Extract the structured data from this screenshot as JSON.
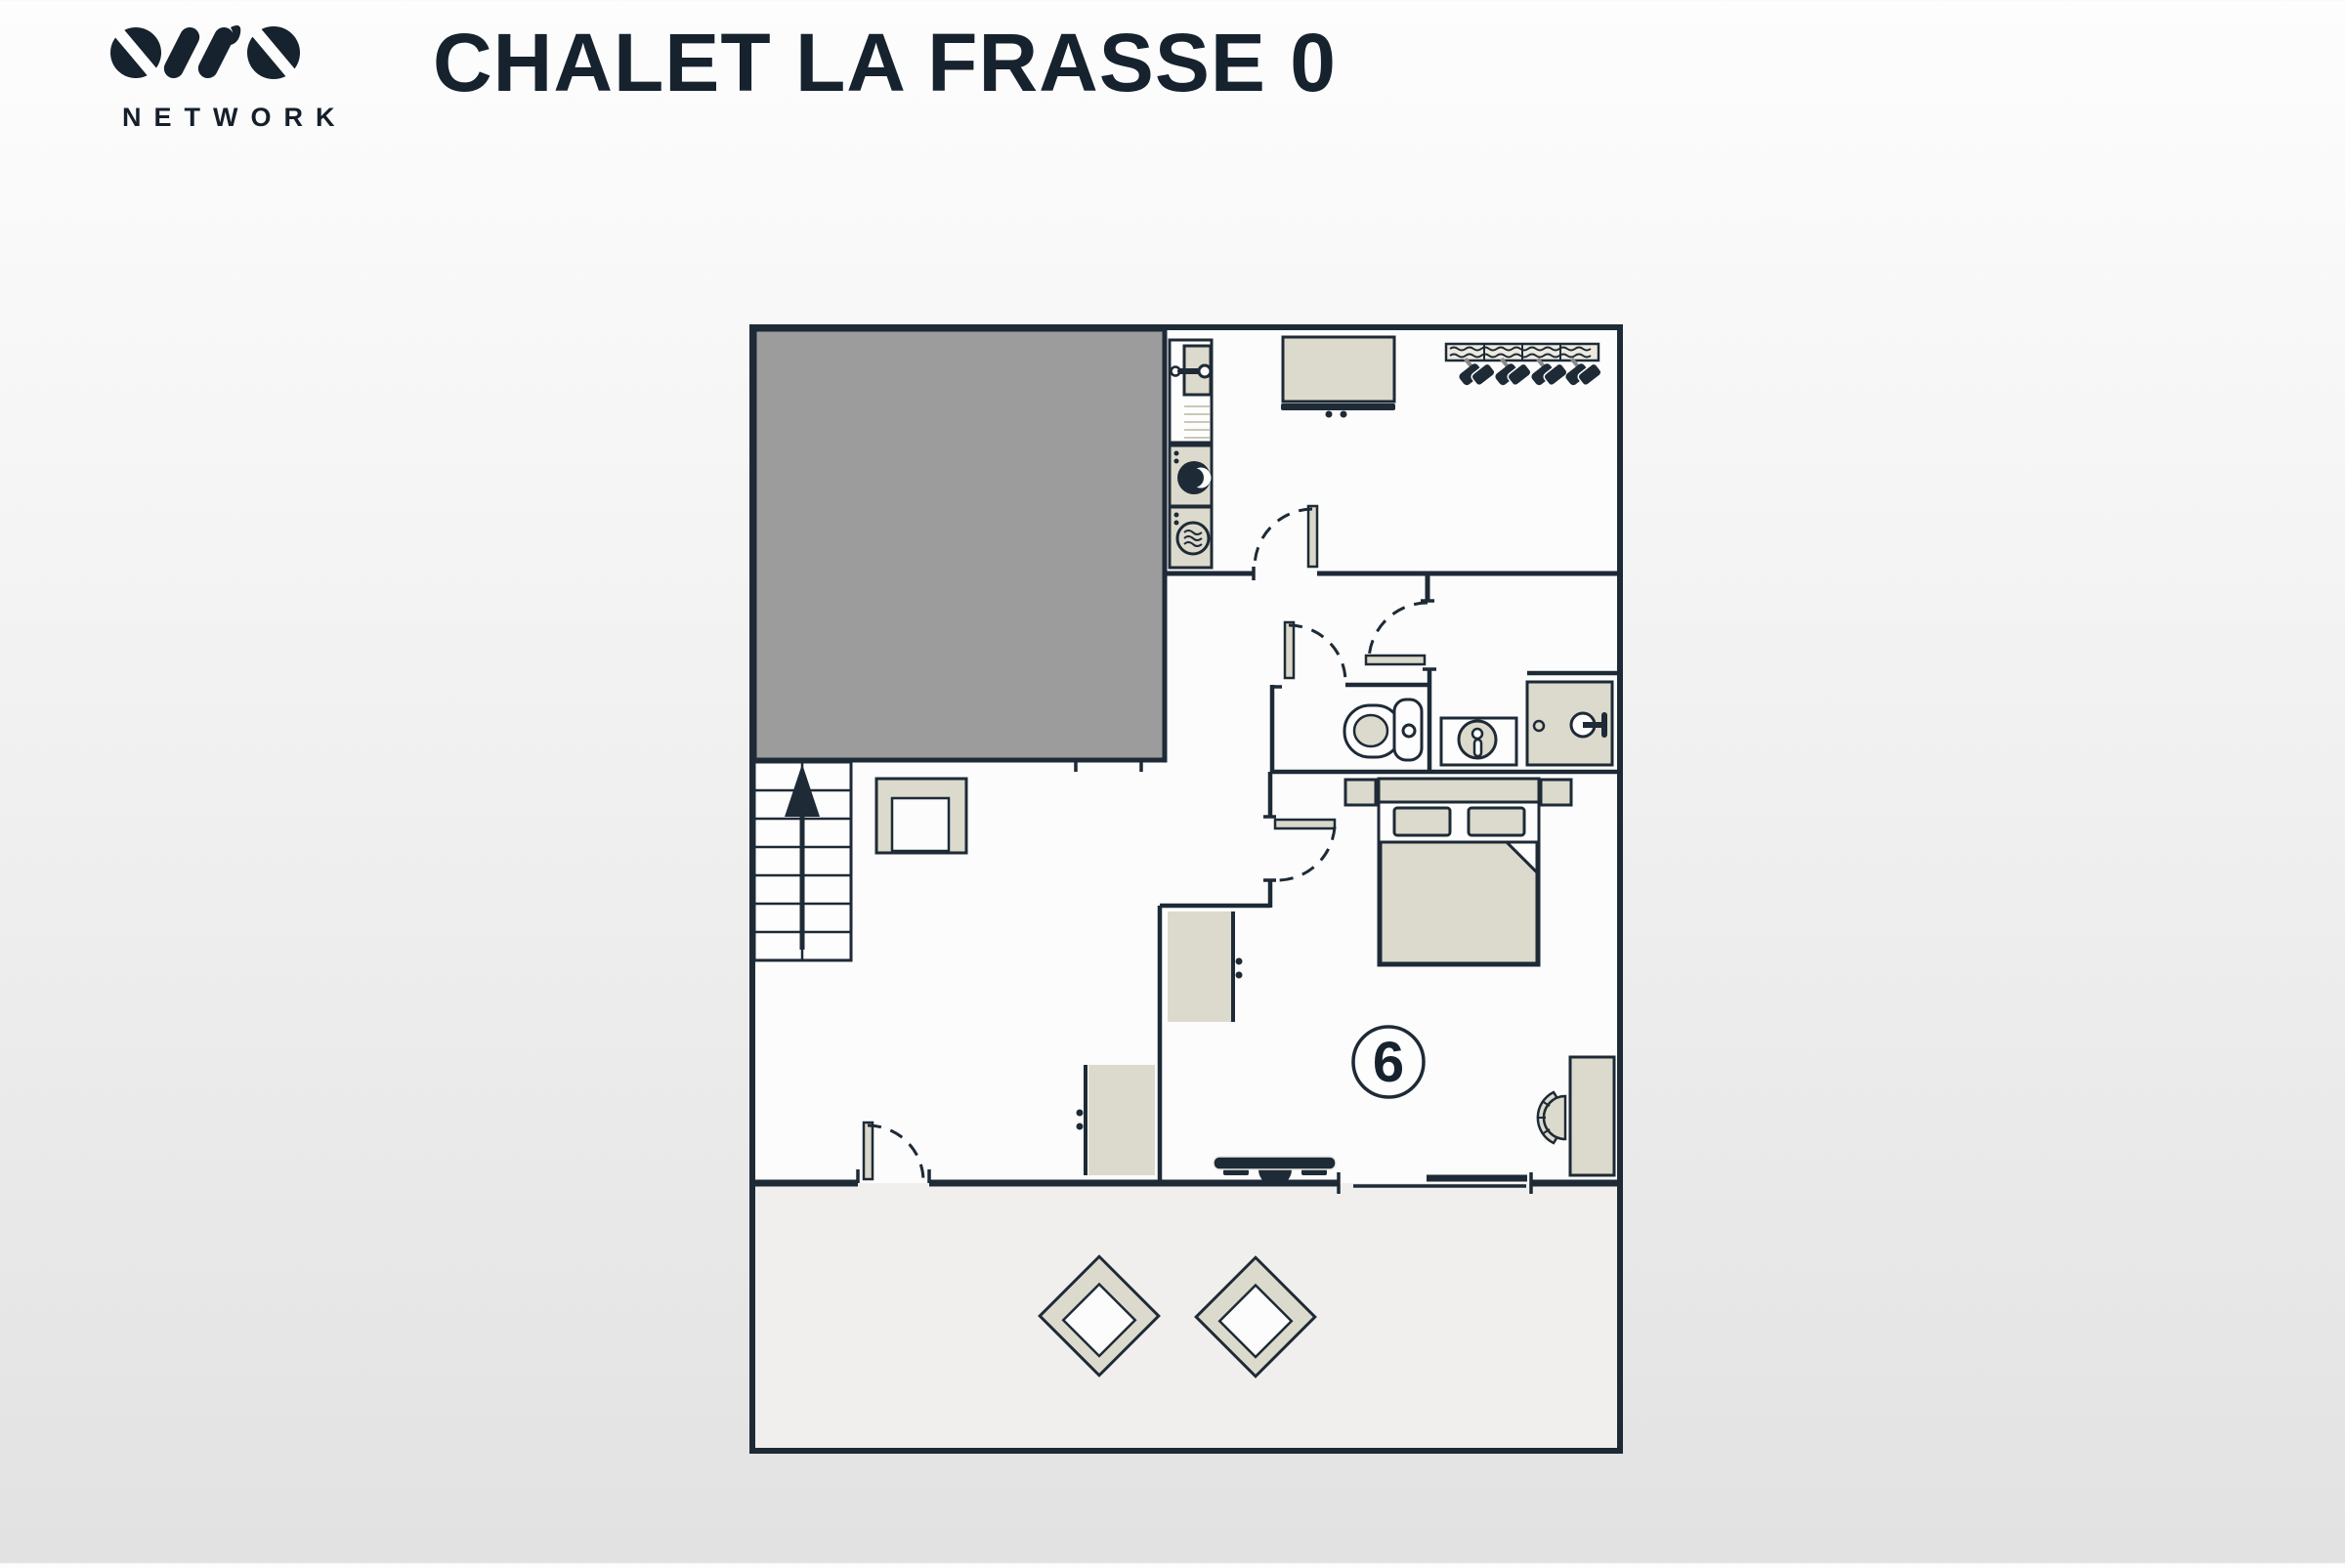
{
  "header": {
    "logo": {
      "icon": "ovo-logo-mark",
      "subtext": "NETWORK"
    },
    "title": "CHALET LA FRASSE 0"
  },
  "plan": {
    "bedroom_number": "6",
    "symbols": [
      "garage-void-area",
      "stairs-up-arrow",
      "sofa",
      "entrance-door",
      "kitchen-sink-unit",
      "washing-machine",
      "tumble-dryer",
      "sideboard",
      "boot-warmer-rack",
      "interior-door",
      "toilet",
      "washbasin",
      "shower-cubicle",
      "double-bed",
      "nightstand",
      "wardrobe",
      "tv",
      "desk",
      "desk-chair",
      "sliding-window",
      "terrace-armchair"
    ]
  },
  "colors": {
    "wall": "#1e2a36",
    "furniture_fill": "#dbdacc",
    "garage_fill": "#9c9c9c",
    "floor_fill": "#fcfcfc",
    "terrace_fill": "#f0efee",
    "title_color": "#16222d",
    "background_top": "#fdfdfd",
    "background_bottom": "#e2e2e2"
  }
}
